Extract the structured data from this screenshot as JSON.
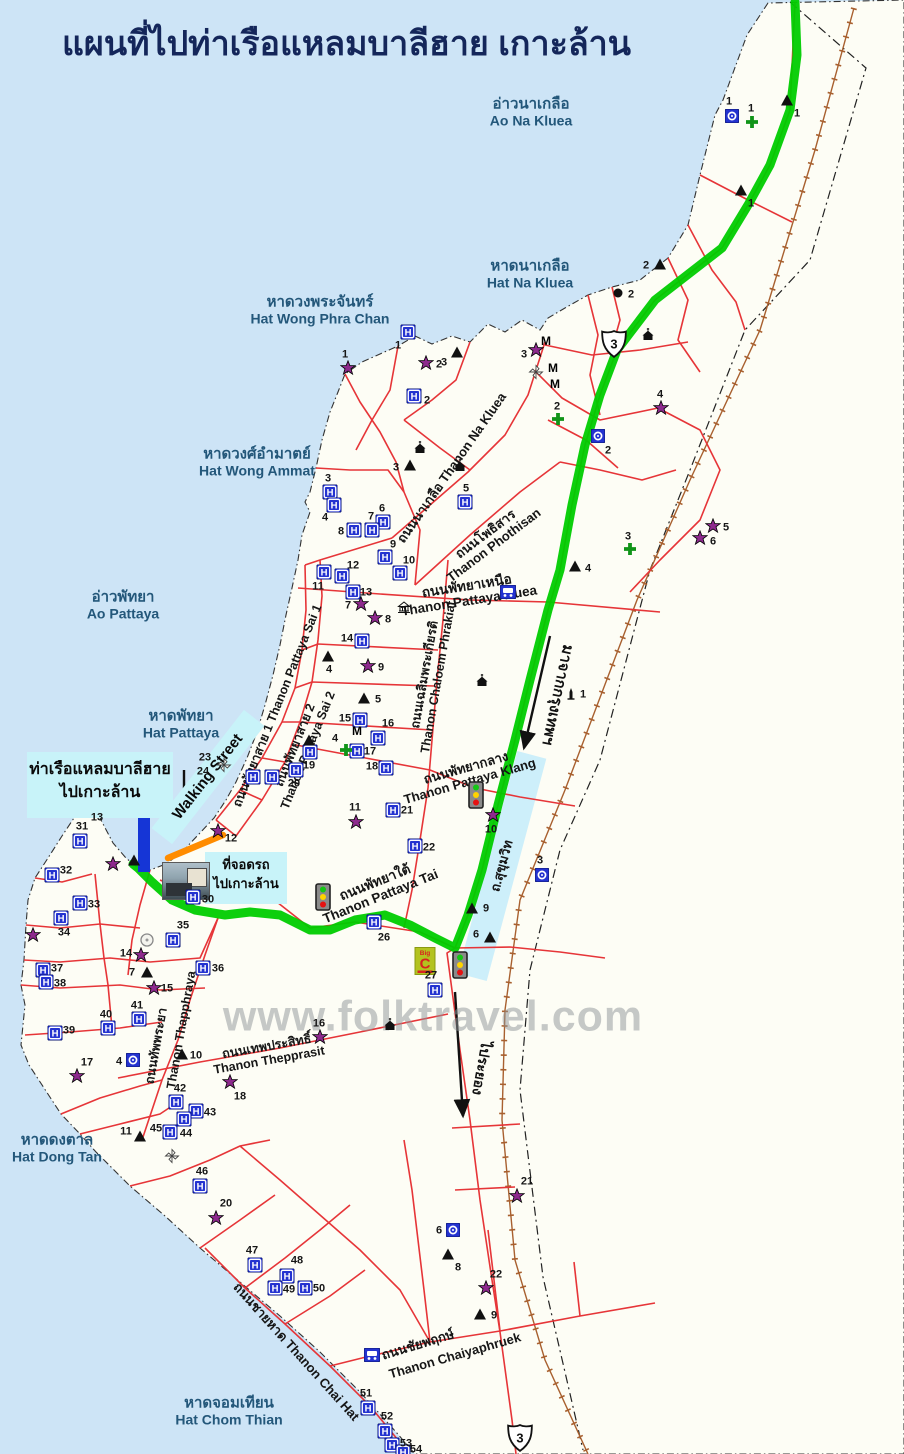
{
  "title": "แผนที่ไปท่าเรือแหลมบาลีฮาย เกาะล้าน",
  "watermark": "www.folktravel.com",
  "colors": {
    "sea": "#cde4f6",
    "land": "#fdfdf5",
    "road": "#e63538",
    "route": "#00cc00",
    "railway": "#a8602f",
    "boundary": "#333333",
    "highlight_box": "#c8f3f9",
    "pier": "#1535d6",
    "walking_street_orange": "#ff8c00",
    "hotel_blue": "#2433d0",
    "star_purple": "#8d2a8d",
    "cross_green": "#109418"
  },
  "sea_labels": [
    {
      "thai": "อ่าวนาเกลือ",
      "eng": "Ao Na Kluea",
      "x": 531,
      "y": 112
    },
    {
      "thai": "หาดนาเกลือ",
      "eng": "Hat Na Kluea",
      "x": 530,
      "y": 274
    },
    {
      "thai": "หาดวงพระจันทร์",
      "eng": "Hat Wong Phra Chan",
      "x": 320,
      "y": 310
    },
    {
      "thai": "หาดวงศ์อำมาตย์",
      "eng": "Hat Wong Ammat",
      "x": 257,
      "y": 462
    },
    {
      "thai": "อ่าวพัทยา",
      "eng": "Ao Pattaya",
      "x": 123,
      "y": 605
    },
    {
      "thai": "หาดพัทยา",
      "eng": "Hat Pattaya",
      "x": 181,
      "y": 724
    },
    {
      "thai": "หาดดงตาล",
      "eng": "Hat Dong Tan",
      "x": 57,
      "y": 1148
    },
    {
      "thai": "หาดจอมเทียน",
      "eng": "Hat Chom Thian",
      "x": 229,
      "y": 1411
    }
  ],
  "road_labels": [
    {
      "lines": [
        "ถนนนาเกลือ  Thanon Na Kluea"
      ],
      "x": 452,
      "y": 468,
      "rot": -55,
      "size": 13
    },
    {
      "lines": [
        "ถนนโพธิสาร",
        "Thanon Phothisan"
      ],
      "x": 490,
      "y": 540,
      "rot": -37,
      "size": 13
    },
    {
      "lines": [
        "ถนนพัทยาเหนือ",
        "Thanon Pattaya Nuea"
      ],
      "x": 468,
      "y": 594,
      "rot": -9,
      "size": 13.5
    },
    {
      "lines": [
        "ถนนเฉลิมพระเกียรติ",
        "Thanon Chaloem Phrakiat"
      ],
      "x": 432,
      "y": 676,
      "rot": -80,
      "size": 12.5
    },
    {
      "lines": [
        "ถนนพัทยาสาย 1  Thanon Pattaya Sai 1"
      ],
      "x": 278,
      "y": 706,
      "rot": -68,
      "size": 12.5
    },
    {
      "lines": [
        "ถนนพัทยาสาย 2",
        "Thanon Pattaya Sai 2"
      ],
      "x": 302,
      "y": 748,
      "rot": -68,
      "size": 12.5
    },
    {
      "lines": [
        "ถนนพัทยากลาง",
        "Thanon Pattaya Klang"
      ],
      "x": 468,
      "y": 775,
      "rot": -16,
      "size": 13
    },
    {
      "lines": [
        "ถนนพัทยาใต้",
        "Thanon Pattaya Tai"
      ],
      "x": 378,
      "y": 890,
      "rot": -22,
      "size": 13.5
    },
    {
      "lines": [
        "ถนนทัพพระยา"
      ],
      "x": 157,
      "y": 1046,
      "rot": -80,
      "size": 12.5
    },
    {
      "lines": [
        "Thanon Thapphraya"
      ],
      "x": 182,
      "y": 1030,
      "rot": -80,
      "size": 12.5
    },
    {
      "lines": [
        "ถนนเทพประสิทธิ์",
        "Thanon Thepprasit"
      ],
      "x": 268,
      "y": 1054,
      "rot": -10,
      "size": 12.5
    },
    {
      "lines": [
        "ถนนชายหาด Thanon Chai Hat"
      ],
      "x": 296,
      "y": 1352,
      "rot": 48,
      "size": 13
    },
    {
      "lines": [
        "ถนนชัยพฤกษ์"
      ],
      "x": 418,
      "y": 1345,
      "rot": -17,
      "size": 13
    },
    {
      "lines": [
        "Thanon Chaiyaphruek"
      ],
      "x": 455,
      "y": 1356,
      "rot": -16,
      "size": 13
    }
  ],
  "boxes": {
    "pier": {
      "line1": "ท่าเรือแหลมบาลีฮาย",
      "line2": "ไปเกาะล้าน",
      "x": 27,
      "y": 752,
      "w": 146,
      "h": 60
    },
    "parking": {
      "line1": "ที่จอดรถ",
      "line2": "ไปเกาะล้าน",
      "x": 205,
      "y": 852,
      "w": 82,
      "h": 48
    },
    "walking_street": {
      "text": "Walking Street",
      "x": 208,
      "y": 777,
      "rot": -52,
      "len": 150,
      "wid": 26
    },
    "sukhumvit_band": {
      "text": "ถ.สุขุมวิท",
      "x": 502,
      "y": 866,
      "rot": -75,
      "len": 230,
      "wid": 30
    }
  },
  "directions": [
    {
      "text": "มาจากกรุงเทพฯ",
      "x": 558,
      "y": 695,
      "rot": 102,
      "size": 15
    },
    {
      "text": "ไประยอง",
      "x": 481,
      "y": 1068,
      "rot": 100,
      "size": 14
    }
  ],
  "highway_shields": [
    {
      "n": "3",
      "x": 614,
      "y": 344
    },
    {
      "n": "3",
      "x": 520,
      "y": 1438
    }
  ],
  "markers": {
    "hotels": [
      {
        "n": "1",
        "x": 408,
        "y": 332,
        "ldx": -10,
        "ldy": 14
      },
      {
        "n": "2",
        "x": 414,
        "y": 396,
        "ldx": 13,
        "ldy": 5
      },
      {
        "n": "3",
        "x": 330,
        "y": 492,
        "ldx": -2,
        "ldy": -13
      },
      {
        "n": "4",
        "x": 334,
        "y": 505,
        "ldx": -9,
        "ldy": 13
      },
      {
        "n": "5",
        "x": 465,
        "y": 502,
        "ldx": 1,
        "ldy": -13
      },
      {
        "n": "6",
        "x": 383,
        "y": 522,
        "ldx": -1,
        "ldy": -13
      },
      {
        "n": "7",
        "x": 372,
        "y": 530,
        "ldx": -1,
        "ldy": -13
      },
      {
        "n": "8",
        "x": 354,
        "y": 530,
        "ldx": -13,
        "ldy": 2
      },
      {
        "n": "9",
        "x": 385,
        "y": 557,
        "ldx": 8,
        "ldy": -12
      },
      {
        "n": "10",
        "x": 400,
        "y": 573,
        "ldx": 9,
        "ldy": -12
      },
      {
        "n": "11",
        "x": 324,
        "y": 572,
        "ldx": -6,
        "ldy": 15
      },
      {
        "n": "12",
        "x": 342,
        "y": 576,
        "ldx": 11,
        "ldy": -10
      },
      {
        "n": "13",
        "x": 353,
        "y": 592,
        "ldx": 13,
        "ldy": 1
      },
      {
        "n": "14",
        "x": 362,
        "y": 641,
        "ldx": -15,
        "ldy": -2
      },
      {
        "n": "15",
        "x": 360,
        "y": 720,
        "ldx": -15,
        "ldy": -1
      },
      {
        "n": "16",
        "x": 378,
        "y": 738,
        "ldx": 0,
        "ldy": -14
      },
      {
        "n": "17",
        "x": 357,
        "y": 751,
        "ldx": 13,
        "ldy": 1
      },
      {
        "n": "18",
        "x": 386,
        "y": 768,
        "ldx": -14,
        "ldy": -1
      },
      {
        "n": "19",
        "x": 310,
        "y": 752,
        "ldx": -1,
        "ldy": 14
      },
      {
        "n": "20",
        "x": 296,
        "y": 770,
        "ldx": -2,
        "ldy": 14
      },
      {
        "n": "21",
        "x": 393,
        "y": 810,
        "ldx": 14,
        "ldy": 1
      },
      {
        "n": "22",
        "x": 415,
        "y": 846,
        "ldx": 14,
        "ldy": 2
      },
      {
        "n": "23",
        "x": 253,
        "y": 777,
        "ldx": -48,
        "ldy": -19
      },
      {
        "n": "24",
        "x": 272,
        "y": 777,
        "ldx": -69,
        "ldy": -5
      },
      {
        "n": "26",
        "x": 374,
        "y": 922,
        "ldx": 0,
        "ldy": 16
      },
      {
        "n": "27",
        "x": 435,
        "y": 990,
        "ldx": -4,
        "ldy": -14
      },
      {
        "n": "30",
        "x": 193,
        "y": 897,
        "ldx": 15,
        "ldy": 3
      },
      {
        "n": "31",
        "x": 80,
        "y": 841,
        "ldx": 2,
        "ldy": -14
      },
      {
        "n": "32",
        "x": 52,
        "y": 875,
        "ldx": 14,
        "ldy": -4
      },
      {
        "n": "33",
        "x": 80,
        "y": 903,
        "ldx": 14,
        "ldy": 2
      },
      {
        "n": "34",
        "x": 61,
        "y": 918,
        "ldx": 3,
        "ldy": 15
      },
      {
        "n": "35",
        "x": 173,
        "y": 940,
        "ldx": 0,
        "ldy": -14
      },
      {
        "n": "36",
        "x": 203,
        "y": 968,
        "ldx": 15,
        "ldy": 1
      },
      {
        "n": "37",
        "x": 43,
        "y": 970,
        "ldx": 14,
        "ldy": -1
      },
      {
        "n": "38",
        "x": 46,
        "y": 982,
        "ldx": 14,
        "ldy": 2
      },
      {
        "n": "39",
        "x": 55,
        "y": 1033,
        "ldx": 14,
        "ldy": -2
      },
      {
        "n": "40",
        "x": 108,
        "y": 1028,
        "ldx": -2,
        "ldy": -13
      },
      {
        "n": "41",
        "x": 139,
        "y": 1019,
        "ldx": -2,
        "ldy": -13
      },
      {
        "n": "42",
        "x": 176,
        "y": 1102,
        "ldx": 4,
        "ldy": -13
      },
      {
        "n": "43",
        "x": 196,
        "y": 1111,
        "ldx": 14,
        "ldy": 2
      },
      {
        "n": "44",
        "x": 184,
        "y": 1119,
        "ldx": 2,
        "ldy": 15
      },
      {
        "n": "45",
        "x": 170,
        "y": 1132,
        "ldx": -14,
        "ldy": -3
      },
      {
        "n": "46",
        "x": 200,
        "y": 1186,
        "ldx": 2,
        "ldy": -14
      },
      {
        "n": "47",
        "x": 255,
        "y": 1265,
        "ldx": -3,
        "ldy": -14
      },
      {
        "n": "48",
        "x": 287,
        "y": 1276,
        "ldx": 0,
        "ldy": -15
      },
      {
        "n": "49",
        "x": 275,
        "y": 1288,
        "ldx": 14,
        "ldy": 2
      },
      {
        "n": "50",
        "x": 305,
        "y": 1288,
        "ldx": 14,
        "ldy": 1
      },
      {
        "n": "51",
        "x": 368,
        "y": 1408,
        "ldx": -2,
        "ldy": -14
      },
      {
        "n": "52",
        "x": 385,
        "y": 1431,
        "ldx": 2,
        "ldy": -14
      },
      {
        "n": "53",
        "x": 392,
        "y": 1445,
        "ldx": 14,
        "ldy": -1
      },
      {
        "n": "54",
        "x": 403,
        "y": 1452,
        "ldx": 13,
        "ldy": -2
      }
    ],
    "stars": [
      {
        "n": "1",
        "x": 348,
        "y": 368,
        "ldx": -3,
        "ldy": -13
      },
      {
        "n": "2",
        "x": 426,
        "y": 363,
        "ldx": 13,
        "ldy": 2
      },
      {
        "n": "3",
        "x": 536,
        "y": 350,
        "ldx": -12,
        "ldy": 5
      },
      {
        "n": "4",
        "x": 661,
        "y": 408,
        "ldx": -1,
        "ldy": -13
      },
      {
        "n": "5",
        "x": 713,
        "y": 526,
        "ldx": 13,
        "ldy": 2
      },
      {
        "n": "6",
        "x": 700,
        "y": 538,
        "ldx": 13,
        "ldy": 4
      },
      {
        "n": "7",
        "x": 361,
        "y": 604,
        "ldx": -13,
        "ldy": 2
      },
      {
        "n": "8",
        "x": 375,
        "y": 618,
        "ldx": 13,
        "ldy": 2
      },
      {
        "n": "9",
        "x": 368,
        "y": 666,
        "ldx": 13,
        "ldy": 2
      },
      {
        "n": "10",
        "x": 493,
        "y": 815,
        "ldx": -2,
        "ldy": 15
      },
      {
        "n": "11",
        "x": 356,
        "y": 822,
        "ldx": -1,
        "ldy": -14
      },
      {
        "n": "12",
        "x": 218,
        "y": 831,
        "ldx": 13,
        "ldy": 8
      },
      {
        "n": "13",
        "x": 113,
        "y": 864,
        "ldx": -16,
        "ldy": -46
      },
      {
        "n": "14",
        "x": 141,
        "y": 955,
        "ldx": -15,
        "ldy": -1
      },
      {
        "n": "15",
        "x": 154,
        "y": 988,
        "ldx": 13,
        "ldy": 1
      },
      {
        "n": "16",
        "x": 320,
        "y": 1037,
        "ldx": -1,
        "ldy": -13
      },
      {
        "n": "17",
        "x": 77,
        "y": 1076,
        "ldx": 0,
        "ldy": -13
      },
      {
        "n": "18",
        "x": 230,
        "y": 1082,
        "ldx": 0,
        "ldy": 15
      },
      {
        "n": "20",
        "x": 216,
        "y": 1218,
        "ldx": 0,
        "ldy": -14
      },
      {
        "n": "21",
        "x": 517,
        "y": 1196,
        "ldx": 0,
        "ldy": -14
      },
      {
        "n": "22",
        "x": 486,
        "y": 1288,
        "ldx": 0,
        "ldy": -13
      },
      {
        "n": "",
        "x": 33,
        "y": 935,
        "ldx": 0,
        "ldy": 0
      }
    ],
    "triangles": [
      {
        "n": "1",
        "x": 787,
        "y": 100,
        "ldx": 0,
        "ldy": 14
      },
      {
        "n": "1",
        "x": 741,
        "y": 190,
        "ldx": 0,
        "ldy": 14
      },
      {
        "n": "2",
        "x": 660,
        "y": 264,
        "ldx": -14,
        "ldy": 0
      },
      {
        "n": "3",
        "x": 457,
        "y": 352,
        "ldx": -13,
        "ldy": 11
      },
      {
        "n": "3",
        "x": 410,
        "y": 465,
        "ldx": -14,
        "ldy": 3
      },
      {
        "n": "4",
        "x": 575,
        "y": 566,
        "ldx": 13,
        "ldy": 3
      },
      {
        "n": "4",
        "x": 328,
        "y": 656,
        "ldx": 1,
        "ldy": 14
      },
      {
        "n": "5",
        "x": 364,
        "y": 698,
        "ldx": 14,
        "ldy": 0
      },
      {
        "n": "6",
        "x": 490,
        "y": 937,
        "ldx": -14,
        "ldy": -2
      },
      {
        "n": "7",
        "x": 147,
        "y": 972,
        "ldx": -15,
        "ldy": 1
      },
      {
        "n": "9",
        "x": 472,
        "y": 908,
        "ldx": 14,
        "ldy": 1
      },
      {
        "n": "8",
        "x": 448,
        "y": 1254,
        "ldx": 0,
        "ldy": 14
      },
      {
        "n": "9",
        "x": 480,
        "y": 1314,
        "ldx": 14,
        "ldy": 2
      },
      {
        "n": "10",
        "x": 182,
        "y": 1054,
        "ldx": 14,
        "ldy": 2
      },
      {
        "n": "11",
        "x": 140,
        "y": 1136,
        "ldx": -14,
        "ldy": -4
      },
      {
        "n": "",
        "x": 309,
        "y": 740,
        "ldx": 0,
        "ldy": 0
      },
      {
        "n": "",
        "x": 134,
        "y": 860,
        "ldx": 0,
        "ldy": 0
      }
    ],
    "crosses": [
      {
        "n": "1",
        "x": 752,
        "y": 122,
        "ldx": -1,
        "ldy": -13
      },
      {
        "n": "2",
        "x": 558,
        "y": 419,
        "ldx": -1,
        "ldy": -12
      },
      {
        "n": "3",
        "x": 630,
        "y": 549,
        "ldx": -2,
        "ldy": -12
      },
      {
        "n": "4",
        "x": 346,
        "y": 750,
        "ldx": -11,
        "ldy": -11
      }
    ],
    "info": [
      {
        "n": "1",
        "x": 732,
        "y": 116,
        "ldx": -3,
        "ldy": -14
      },
      {
        "n": "2",
        "x": 598,
        "y": 436,
        "ldx": 0,
        "ldy": 15
      },
      {
        "n": "3",
        "x": 542,
        "y": 875,
        "ldx": -2,
        "ldy": -14
      },
      {
        "n": "4",
        "x": 133,
        "y": 1060,
        "ldx": -14,
        "ldy": 2
      },
      {
        "n": "6",
        "x": 453,
        "y": 1230,
        "ldx": -14,
        "ldy": 1
      }
    ],
    "buses": [
      {
        "x": 508,
        "y": 592
      },
      {
        "x": 372,
        "y": 1355
      }
    ],
    "m_flags": [
      {
        "x": 546,
        "y": 341
      },
      {
        "x": 553,
        "y": 368
      },
      {
        "x": 555,
        "y": 384
      },
      {
        "x": 357,
        "y": 731
      }
    ],
    "dots": [
      {
        "n": "2",
        "x": 618,
        "y": 293,
        "ldx": 13,
        "ldy": 2
      }
    ],
    "windmills": [
      {
        "x": 536,
        "y": 372
      },
      {
        "x": 224,
        "y": 765
      },
      {
        "x": 172,
        "y": 1156
      }
    ],
    "circles": [
      {
        "x": 147,
        "y": 940
      }
    ],
    "temples": [
      {
        "x": 648,
        "y": 334
      },
      {
        "x": 420,
        "y": 447
      },
      {
        "x": 460,
        "y": 465
      },
      {
        "x": 482,
        "y": 680
      },
      {
        "x": 390,
        "y": 1024
      }
    ],
    "museums": [
      {
        "x": 404,
        "y": 607
      }
    ],
    "monuments": [
      {
        "n": "1",
        "x": 571,
        "y": 693,
        "ldx": 12,
        "ldy": 0
      }
    ],
    "traffic_lights": [
      {
        "x": 476,
        "y": 795
      },
      {
        "x": 323,
        "y": 897
      },
      {
        "x": 460,
        "y": 965
      }
    ],
    "bigc": {
      "top": "Big",
      "letter": "C",
      "x": 425,
      "y": 961
    },
    "pier_rect": {
      "x": 138,
      "y": 815,
      "w": 12,
      "h": 57
    },
    "photo": {
      "x": 162,
      "y": 862,
      "w": 46,
      "h": 36
    }
  }
}
